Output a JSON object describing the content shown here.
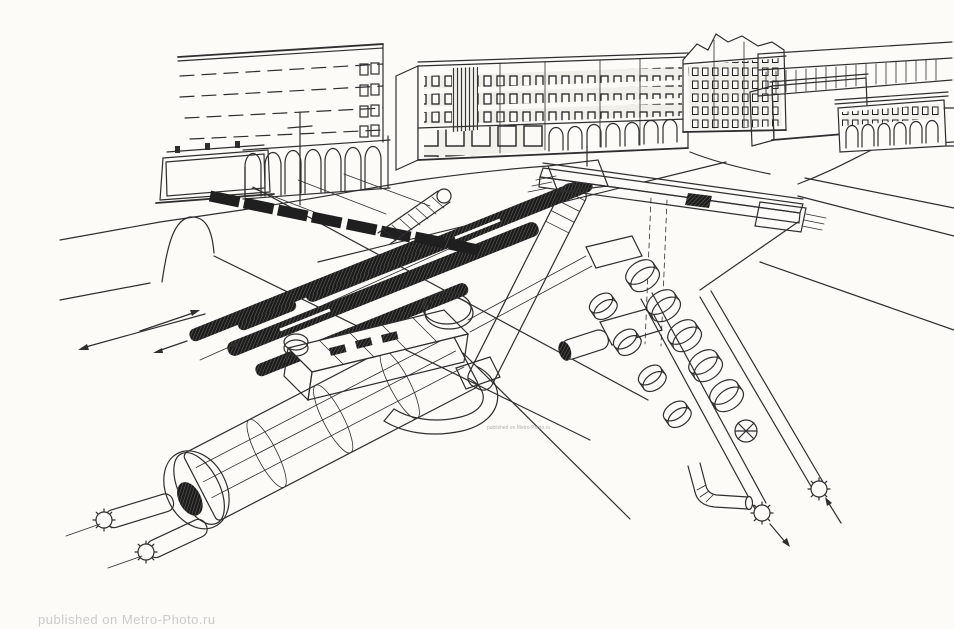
{
  "colors": {
    "paper": "#fcfbf8",
    "ink": "#2e2e2e",
    "hatch-dark": "#1f1f1f",
    "watermark": "#cbcbcb"
  },
  "watermark": {
    "text": "published on Metro-Photo.ru"
  },
  "tiny_watermark": {
    "text": "published on Metro-Photo.ru"
  }
}
